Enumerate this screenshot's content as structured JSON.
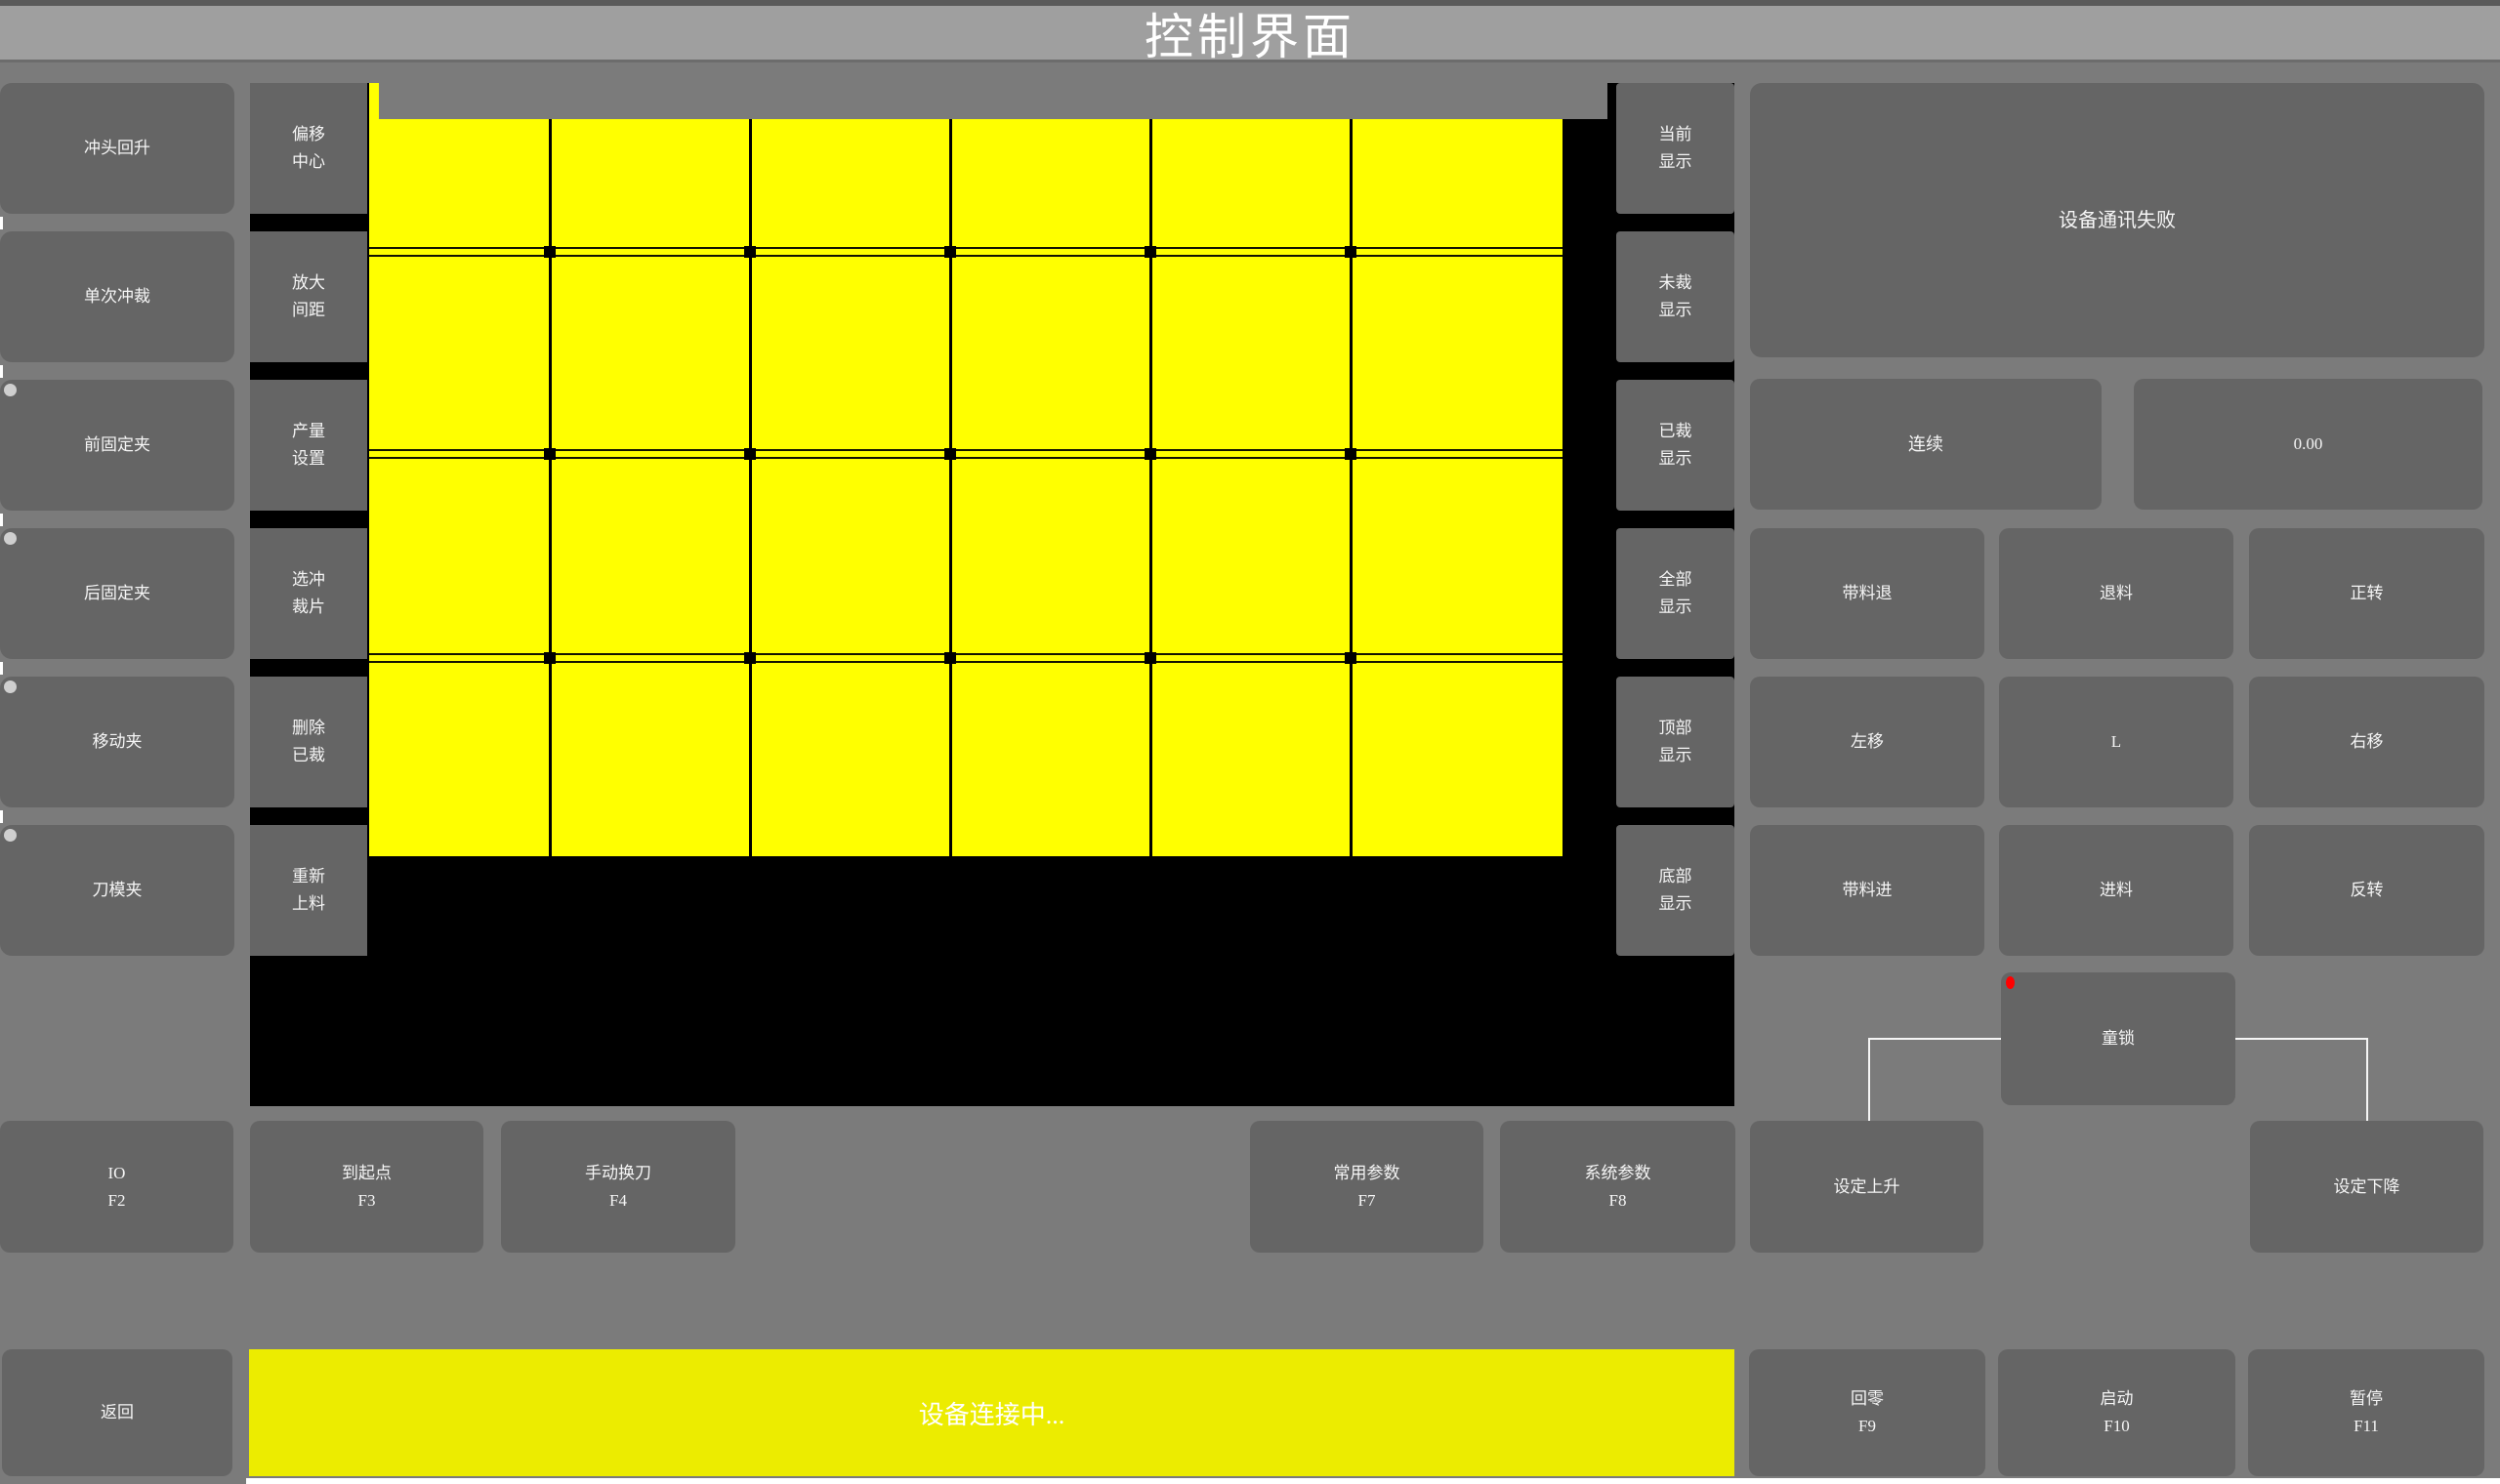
{
  "title": "控制界面",
  "left_panel": {
    "buttons": [
      {
        "label": "冲头回升",
        "indicator": false
      },
      {
        "label": "单次冲裁",
        "indicator": false
      },
      {
        "label": "前固定夹",
        "indicator": true
      },
      {
        "label": "后固定夹",
        "indicator": true
      },
      {
        "label": "移动夹",
        "indicator": true
      },
      {
        "label": "刀模夹",
        "indicator": true
      }
    ]
  },
  "tool_column": {
    "buttons": [
      {
        "label": "偏移\n中心"
      },
      {
        "label": "放大\n间距"
      },
      {
        "label": "产量\n设置"
      },
      {
        "label": "选冲\n裁片"
      },
      {
        "label": "删除\n已裁"
      },
      {
        "label": "重新\n上料"
      }
    ]
  },
  "display_column": {
    "buttons": [
      {
        "label": "当前\n显示"
      },
      {
        "label": "未裁\n显示"
      },
      {
        "label": "已裁\n显示"
      },
      {
        "label": "全部\n显示"
      },
      {
        "label": "顶部\n显示"
      },
      {
        "label": "底部\n显示"
      }
    ]
  },
  "cut_preview": {
    "rows": 4,
    "columns": 6,
    "cell_color": "#ffff00",
    "background": "#000000"
  },
  "right_panel": {
    "status_message": "设备通讯失败",
    "mode_button": "连续",
    "value_display": "0.00",
    "jog_buttons": [
      "带料退",
      "退料",
      "正转",
      "左移",
      "L",
      "右移",
      "带料进",
      "进料",
      "反转"
    ],
    "child_lock": {
      "label": "童锁"
    }
  },
  "function_row": {
    "io": "IO\nF2",
    "to_origin": "到起点\nF3",
    "manual_tool_change": "手动换刀\nF4",
    "common_params": "常用参数\nF7",
    "system_params": "系统参数\nF8",
    "set_rise": "设定上升",
    "set_fall": "设定下降"
  },
  "bottom_bar": {
    "back": "返回",
    "connection_status": "设备连接中...",
    "home": "回零\nF9",
    "start": "启动\nF10",
    "pause": "暂停\nF11"
  },
  "colors": {
    "grid_yellow": "#ffff00",
    "statusbar_yellow": "#ecec00",
    "button_gray": "#656565",
    "background_gray": "#7b7b7b",
    "titlebar_gray": "#9f9f9f",
    "panel_black": "#000000",
    "indicator_red": "#ff0000",
    "indicator_light": "#cfcfcf"
  }
}
